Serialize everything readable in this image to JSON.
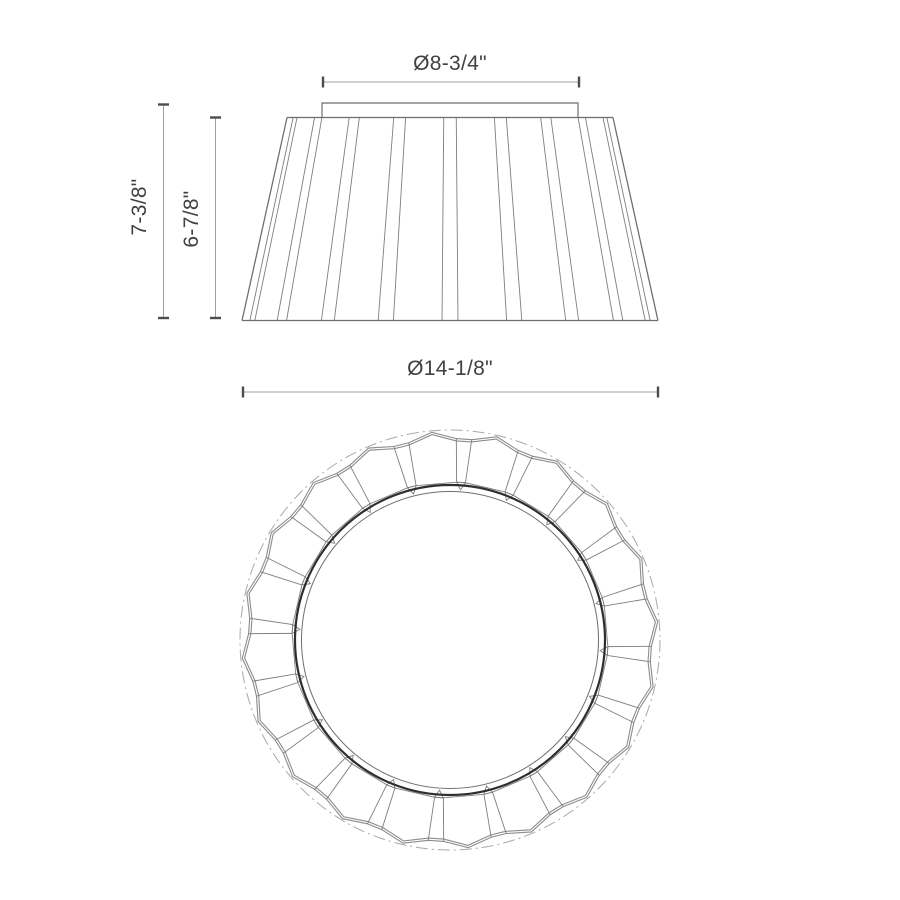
{
  "dimension_labels": {
    "top_diameter": "Ø8-3/4\"",
    "overall_height": "7-3/8\"",
    "shade_height": "6-7/8\"",
    "bottom_diameter": "Ø14-1/8\""
  },
  "drawing": {
    "canvas": {
      "width": 900,
      "height": 900,
      "background": "#ffffff"
    },
    "colors": {
      "outline": "#6d6e71",
      "fold_line": "#7c7e81",
      "pleat_hem": "#8a8c8f",
      "inner_ring_heavy": "#2e2e2e",
      "phantom_circle": "#a7a9ac",
      "dim_line": "#9d9fa2",
      "tick": "#4d4d4f",
      "text": "#414042"
    },
    "elevation": {
      "cx": 450,
      "top_y": 117.5,
      "bottom_y": 320.5,
      "top_half_width": 163,
      "bottom_half_width": 208,
      "cap": {
        "left": 322,
        "top": 103,
        "right": 578
      },
      "pleat_count": 20,
      "sliver_offset_deg": 0,
      "sliver_half_angle_deg": 2.2
    },
    "plan": {
      "cx": 450,
      "cy": 640,
      "phantom_r": 210,
      "peak_r": 208.5,
      "valley_r": 201.5,
      "hem_offset": 2.3,
      "facet_inner_r": 158,
      "notch_tip_r": 150.5,
      "ring_outer_r": 155,
      "ring_inner_r": 148.5,
      "pleat_count": 20,
      "peak_offset_deg": 13,
      "foot_half_angle_deg": 2.2,
      "notch_half_angle_deg": 1.6
    },
    "dims": {
      "top": {
        "y": 82,
        "x1": 323,
        "x2": 579
      },
      "left_outer": {
        "x": 163.5,
        "y1": 104.5,
        "y2": 318
      },
      "left_inner": {
        "x": 215.5,
        "y1": 117.5,
        "y2": 318
      },
      "bottom": {
        "y": 392,
        "x1": 243,
        "x2": 658
      },
      "tick_len": 11
    }
  }
}
